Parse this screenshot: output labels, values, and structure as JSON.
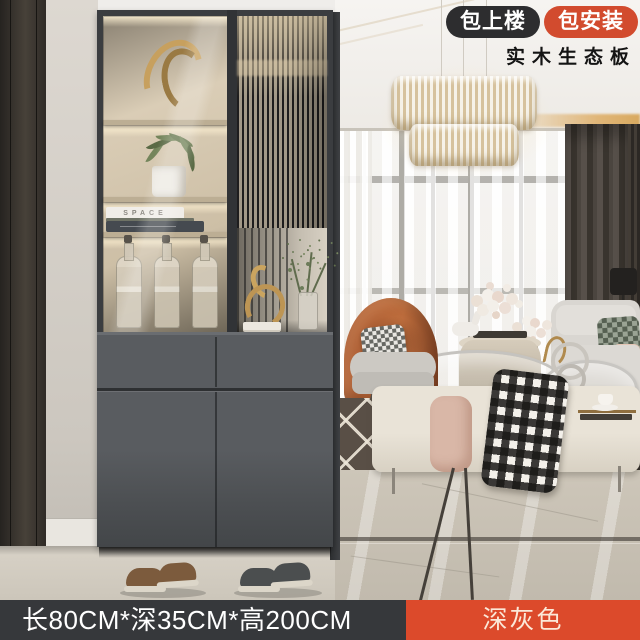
{
  "badges": {
    "carry_upstairs": "包上楼",
    "installation": "包安装",
    "material": "实木生态板"
  },
  "footer": {
    "dimensions": "长80CM*深35CM*高200CM",
    "color_name": "深灰色"
  },
  "cabinet": {
    "book_spine": "SPACE"
  },
  "colors": {
    "badge_dark": "#2d2d2f",
    "badge_red": "#d24b2e",
    "footer_bar": "#36383b",
    "footer_tag": "#dc4a2b",
    "footer_tag_text": "#fbe8d8",
    "cabinet_gray": "#55585c",
    "accent_chair_orange": "#b5653a"
  }
}
